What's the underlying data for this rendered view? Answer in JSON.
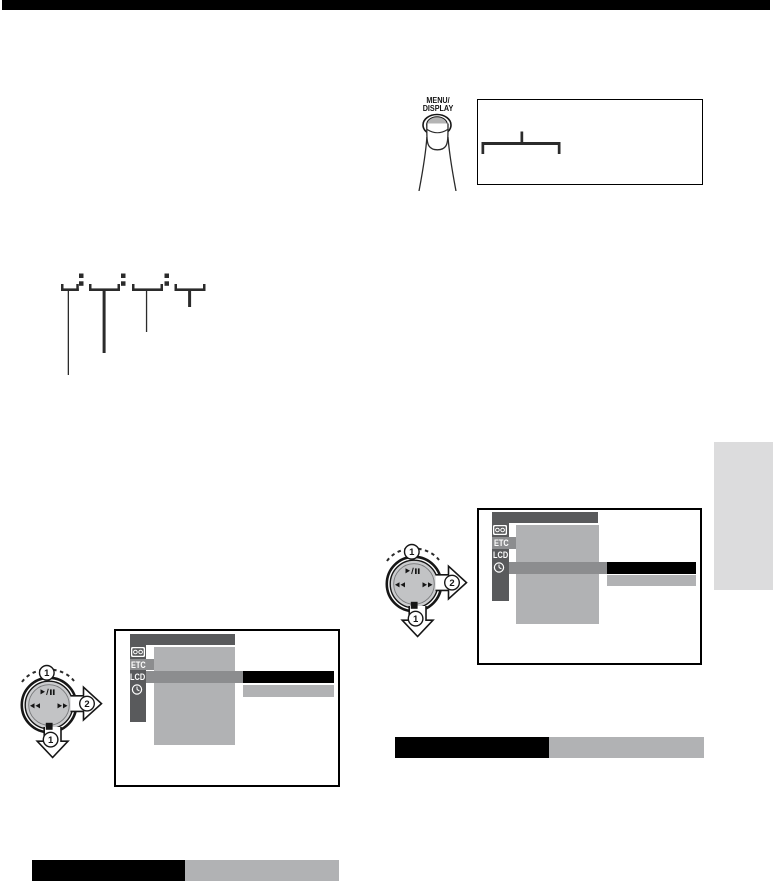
{
  "page": {
    "background": "#ffffff",
    "top_rule_color": "#000000"
  },
  "palette": {
    "screen_dark_gray": "#595a5c",
    "screen_medium_gray": "#8c8d8f",
    "screen_light_gray": "#b1b2b4",
    "dial_gray": "#c2c3c5",
    "button_inner_gray": "#b4b4b4",
    "side_tab_gray": "#dcdcdd",
    "highlight_black": "#000000",
    "line_dark": "#2b2b2b"
  },
  "menu_button": {
    "label_line1": "MENU/",
    "label_line2": "DISPLAY",
    "icons": [
      "finger-press-icon",
      "menu-display-button"
    ]
  },
  "display_box": {
    "icons": [
      "display-indicator-bracket"
    ]
  },
  "timecode_diagram": {
    "groups": 4,
    "separator": ":",
    "icons": [
      "digit-bracket",
      "colon-dots",
      "callout-line"
    ]
  },
  "jog_dial": {
    "step_1": "1",
    "step_2": "2",
    "icons": [
      "rotate-arc",
      "play-pause-icon",
      "rewind-icon",
      "fast-forward-icon",
      "stop-notch",
      "press-down-arrow",
      "push-right-arrow"
    ]
  },
  "menu_screens": {
    "left": {
      "etc_label": "ETC",
      "lcd_label": "LCD",
      "sidebar_icons": [
        "cassette-icon",
        "clock-icon"
      ],
      "selected_row": "LCD"
    },
    "right": {
      "etc_label": "ETC",
      "lcd_label": "LCD",
      "sidebar_icons": [
        "cassette-icon",
        "clock-icon"
      ],
      "selected_row": "clock"
    }
  }
}
